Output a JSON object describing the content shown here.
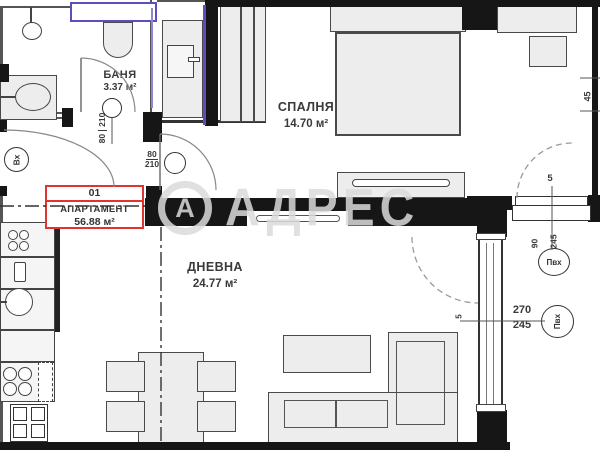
{
  "watermark": {
    "logo_letter": "А",
    "text": "АДРЕС"
  },
  "apartment": {
    "number": "01",
    "label": "АПАРТАМЕНТ",
    "area": "56.88 м²"
  },
  "rooms": {
    "bathroom": {
      "name": "БАНЯ",
      "area": "3.37 м²"
    },
    "bedroom": {
      "name": "СПАЛНЯ",
      "area": "14.70 м²"
    },
    "living": {
      "name": "ДНЕВНА",
      "area": "24.77 м²"
    }
  },
  "entrance": {
    "label": "Вх"
  },
  "doors": {
    "bathroom": {
      "width": "80",
      "height": "210"
    },
    "bedroom": {
      "width": "80",
      "height": "210"
    }
  },
  "windows": {
    "side": {
      "width": "90",
      "height": "245",
      "material": "Пвх",
      "offset": "5"
    },
    "balcony": {
      "width": "270",
      "height": "245",
      "material": "Пвх",
      "offset": "5"
    },
    "wall_dim": "45"
  },
  "colors": {
    "wall": "#161616",
    "accent_red": "#e23333",
    "accent_purple": "#5b4fc0",
    "furniture_fill": "#ededed",
    "label_text": "#3a3a3a"
  }
}
